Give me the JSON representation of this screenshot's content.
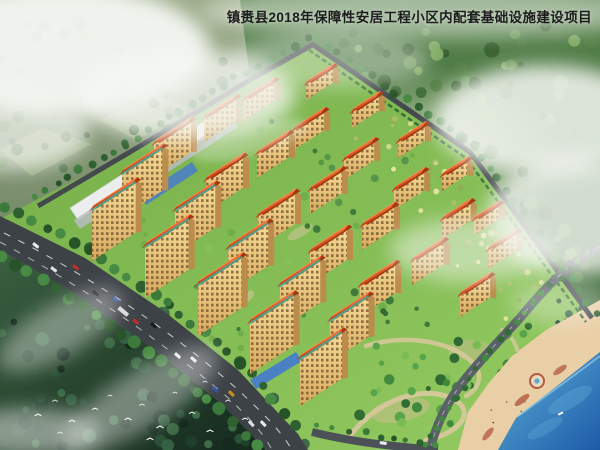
{
  "title": "镇赉县2018年保障性安居工程小区内配套基础设施建设项目",
  "scene": {
    "type": "aerial architectural rendering",
    "features": {
      "residential_area": "orange-roofed apartment blocks",
      "main_road": "tree-lined avenue with traffic",
      "waterfront": "lake with beach and round platform",
      "park": "landscaped park with winding paths",
      "surroundings": "forested hills with mist and clouds",
      "birds": "flock of white birds over dark forest"
    }
  },
  "colors": {
    "title-text": "#1c1c1c",
    "roof": "#d5501e",
    "roof-dark": "#a5360f",
    "ridge": "#ff8d4a",
    "facade": "#f0cd82",
    "facade-shadow": "#bb8c4c",
    "window": "#6b4e2b",
    "teal": "#3fae9e",
    "lawn": "#7cbb52",
    "orchard": "#c3d284",
    "forest": "#4e7a45",
    "forest-dark": "#20402b",
    "hills": "#8a9b7d",
    "road": "#3d4247",
    "road-edge": "#545a60",
    "lane-mark": "#e9eae6",
    "plaza-blue": "#4a80c4",
    "white-roof": "#eceded",
    "path": "#d9c89e",
    "beach": "#e9cfa6",
    "beach-accent": "#b2593f",
    "water": "#2f77bd",
    "water-deep": "#1d5ba8",
    "cloud": "#f5f7f3"
  }
}
